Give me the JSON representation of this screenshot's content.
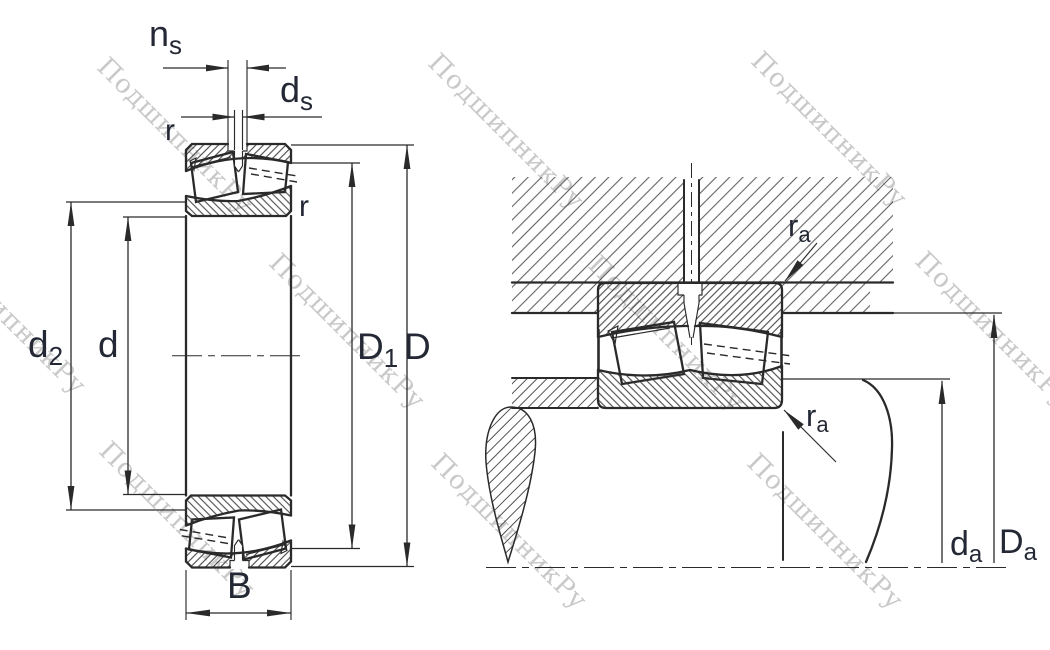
{
  "drawing_title": "spherical-roller-bearing-cross-section-and-mounting-diagram",
  "watermark": {
    "text": "ПодшипникРу"
  },
  "labels": {
    "ns": {
      "main": "n",
      "sub": "s"
    },
    "ds": {
      "main": "d",
      "sub": "s"
    },
    "r_top": {
      "main": "r",
      "sub": ""
    },
    "r_right": {
      "main": "r",
      "sub": ""
    },
    "d2": {
      "main": "d",
      "sub": "2"
    },
    "d": {
      "main": "d",
      "sub": ""
    },
    "D1": {
      "main": "D",
      "sub": "1"
    },
    "D": {
      "main": "D",
      "sub": ""
    },
    "B": {
      "main": "B",
      "sub": ""
    },
    "ra_top": {
      "main": "r",
      "sub": "a"
    },
    "ra_bottom": {
      "main": "r",
      "sub": "a"
    },
    "da": {
      "main": "d",
      "sub": "a"
    },
    "Da": {
      "main": "D",
      "sub": "a"
    }
  },
  "colors": {
    "line": "#2a2a2a",
    "label": "#232834",
    "watermark": "#c9c9c9",
    "background": "#ffffff"
  }
}
